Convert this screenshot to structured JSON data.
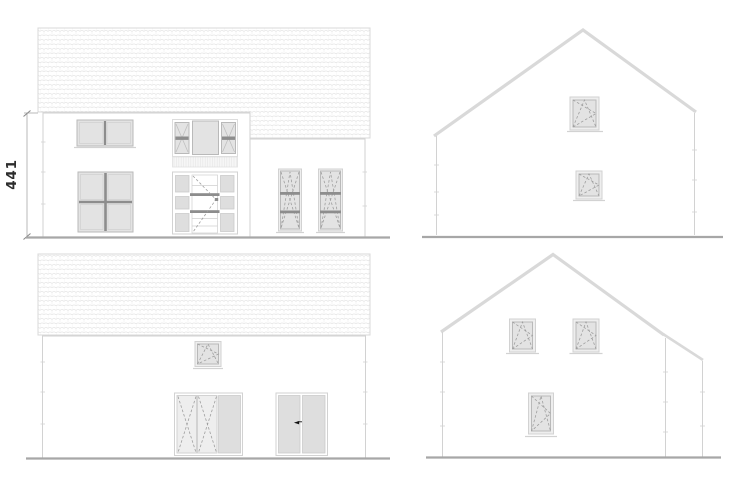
{
  "dimension": {
    "label": "441"
  },
  "icons": {
    "door_swing_arrow": "◄"
  },
  "colors": {
    "background": "#ffffff",
    "wall_line": "#d2d2d2",
    "roof_line": "#d8d8d8",
    "slope": "#d9d9d9",
    "tile_line": "#e6e6e6",
    "glass": "#e3e3e3",
    "glass_light": "#eeeeee",
    "panel": "#dedede",
    "frame": "#b9b9b9",
    "frame_light": "#d2d2d2",
    "mullion": "#8d8d8d",
    "dash": "#9f9f9f",
    "ground": "#a7a7a7",
    "dim_line": "#b3b3b3",
    "text": "#2d2d2d",
    "arrow": "#111111"
  }
}
